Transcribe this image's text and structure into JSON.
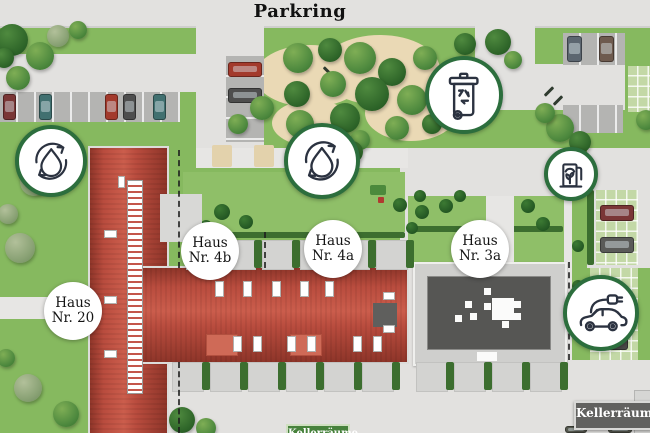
{
  "street": {
    "label": "Parkring"
  },
  "houses": [
    {
      "id": "haus-20",
      "line1": "Haus",
      "line2": "Nr. 20"
    },
    {
      "id": "haus-4b",
      "line1": "Haus",
      "line2": "Nr. 4b"
    },
    {
      "id": "haus-4a",
      "line1": "Haus",
      "line2": "Nr. 4a"
    },
    {
      "id": "haus-3a",
      "line1": "Haus",
      "line2": "Nr. 3a"
    }
  ],
  "signs": {
    "basement_right": "Kellerräume",
    "basement_bottom": "Kellerräume"
  },
  "icons": [
    "water-cycle-icon",
    "water-cycle-icon",
    "waste-recycling-bin-icon",
    "eco-fuel-station-icon",
    "ev-charging-car-icon"
  ],
  "colors": {
    "grass": "#86b95f",
    "road": "#e2e1df",
    "roof_red": "#b94c3e",
    "flat_roof_dark": "#565654",
    "hedge_green": "#3c6e2f",
    "icon_ring_green": "#2c6e3d",
    "icon_stroke": "#2b3240",
    "sand": "#ead9b5",
    "sign_dark": "#61615f",
    "sign_green": "#47823c"
  }
}
